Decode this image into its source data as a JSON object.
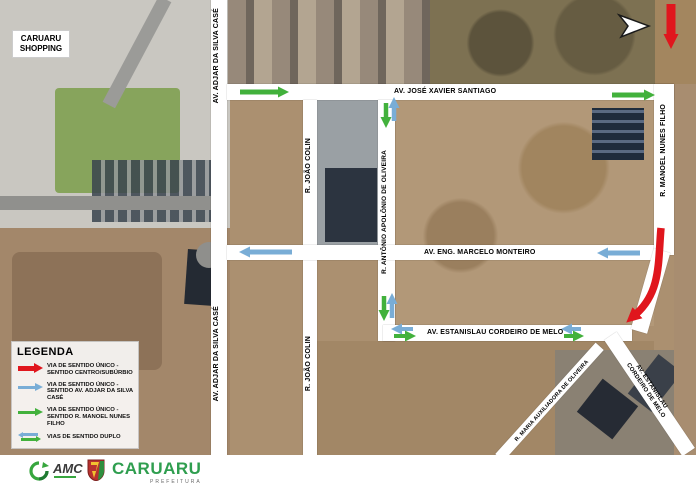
{
  "map": {
    "shopping_box": "CARUARU SHOPPING"
  },
  "streets": {
    "adjar": "AV. ADJAR DA SILVA CASÉ",
    "jose_xavier": "AV. JOSÉ XAVIER SANTIAGO",
    "joao_colin": "R. JOÃO COLIN",
    "antonio_apolonio": "R. ANTÔNIO APOLÔNIO DE OLIVEIRA",
    "marcelo_monteiro": "AV. ENG. MARCELO MONTEIRO",
    "estanislau": "AV. ESTANISLAU CORDEIRO DE MELO",
    "estanislau_l1": "AV. ESTANISLAU",
    "estanislau_l2": "CORDEIRO DE MELO",
    "manoel_nunes": "R. MANOEL NUNES FILHO",
    "maria_auxiliadora": "R. MARIA AUXILIADORA DE OLIVEIRA"
  },
  "legend": {
    "title": "LEGENDA",
    "items": [
      {
        "line1": "VIA DE SENTIDO ÚNICO -",
        "line2": "SENTIDO CENTRO/SUBÚRBIO",
        "color": "#e0161d"
      },
      {
        "line1": "VIA DE SENTIDO ÚNICO -",
        "line2": "SENTIDO AV. ADJAR DA SILVA CASÉ",
        "color": "#79add6"
      },
      {
        "line1": "VIA DE SENTIDO ÚNICO -",
        "line2": "SENTIDO R. MANOEL NUNES FILHO",
        "color": "#42b13c"
      },
      {
        "line1": "VIAS DE SENTIDO DUPLO",
        "line2": "",
        "color": "double"
      }
    ]
  },
  "scale_bar": {
    "ticks": [
      "0",
      "50",
      "100",
      "150 m"
    ]
  },
  "footer": {
    "amc_label": "AMC",
    "city_name": "CARUARU",
    "city_subtitle": "PREFEITURA"
  },
  "colors": {
    "one_way_centro_suburbio": "#e0161d",
    "one_way_adjar": "#79add6",
    "one_way_manoel": "#42b13c",
    "street_band": "#ffffff"
  }
}
